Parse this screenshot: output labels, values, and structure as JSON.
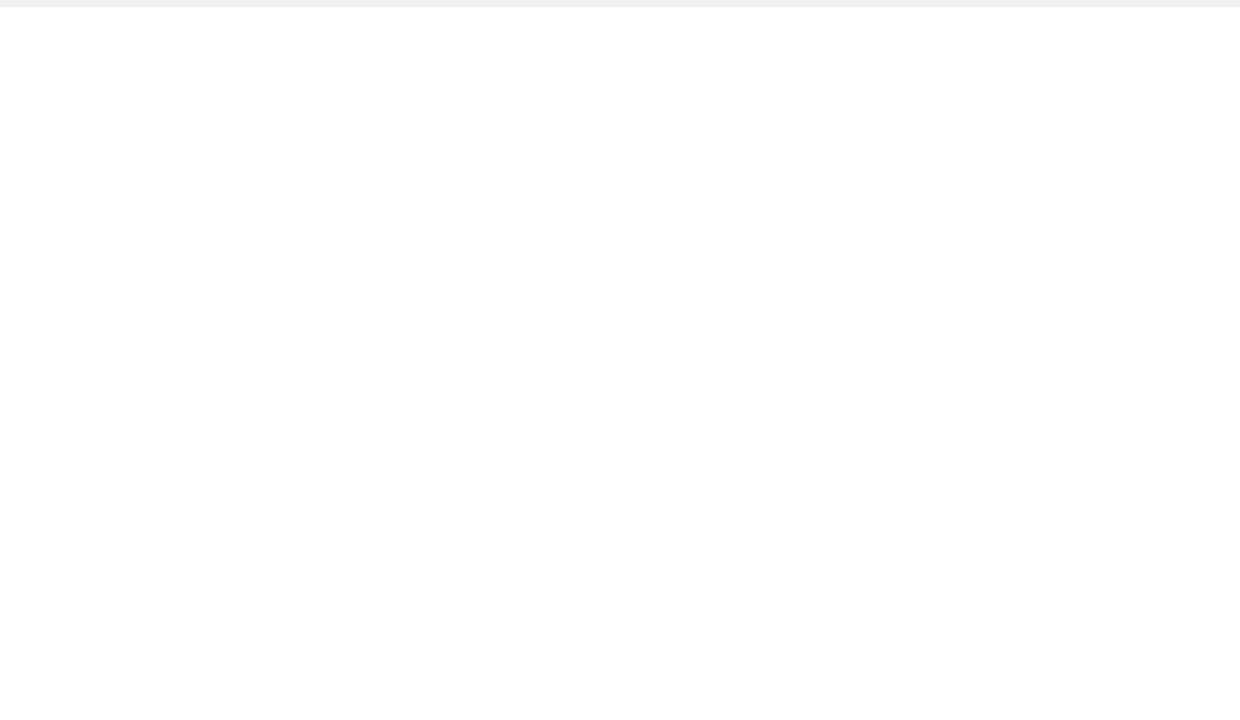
{
  "plan": {
    "band_units": [
      "V05",
      "V06",
      "V07",
      "V08",
      "V09",
      "V10",
      "V11",
      "V12",
      "V13",
      "V14",
      "V15",
      "V16",
      "V17",
      "V18"
    ],
    "block_units": [
      "V01",
      "V02",
      "V03",
      "V04"
    ],
    "annotations": {
      "zonas_comunes_line1": "Zonas Comunes",
      "zonas_comunes_line2": "470,26 m2",
      "lamina_line1": "Lámina de agua",
      "lamina_line2": "62,50 m2",
      "inst1_line1": "Inst. 1",
      "inst1_line2": "Placas",
      "inst2_line1": "Inst. 2",
      "inst2_line2": "Piscina"
    }
  },
  "table": {
    "title": "Resumen de Superficies VIVIENDAS PLANTA BAJA",
    "columns": [
      "",
      "Dormitorios (nº)",
      "Baños (nº)",
      "Parcela (m²)",
      "Ocupación PB (m²)",
      "Construida Total (m²)",
      "Jardines PB (m²)",
      "Terraza (m²)",
      "Solarium (m²)",
      "Trastero (m²)"
    ],
    "rows": [
      [
        "V-01",
        "2",
        "2",
        "355,51",
        "71,71",
        "79,58",
        "174,99",
        "-",
        "-",
        "-"
      ],
      [
        "V-02",
        "2",
        "2",
        "336,08",
        "71,11",
        "77,63",
        "89,13",
        "-",
        "-",
        "-"
      ],
      [
        "V-03",
        "2",
        "2",
        "336,76",
        "71,11",
        "77,63",
        "92,63",
        "-",
        "-",
        "-"
      ],
      [
        "V-04",
        "2",
        "2",
        "336,88",
        "71,71",
        "79,58",
        "119,37",
        "-",
        "-",
        "-"
      ],
      [
        "V-05",
        "2",
        "2",
        "337,83",
        "72,04",
        "80,61",
        "88,19",
        "-",
        "-",
        "-"
      ],
      [
        "V-06",
        "2",
        "2",
        "334,58",
        "71,04",
        "78,65",
        "94,94",
        "-",
        "-",
        "-"
      ],
      [
        "V-07",
        "2",
        "2",
        "336,69",
        "71,04",
        "78,65",
        "93,99",
        "-",
        "-",
        "-"
      ],
      [
        "V-08",
        "2",
        "2",
        "325,40",
        "71,04",
        "78,65",
        "97,45",
        "-",
        "-",
        "-"
      ],
      [
        "V-09",
        "2",
        "2",
        "335,69",
        "71,04",
        "78,65",
        "98,05",
        "-",
        "-",
        "-"
      ],
      [
        "V-10",
        "2",
        "2",
        "355,75",
        "71,18",
        "80,05",
        "98,93",
        "-",
        "-",
        "-"
      ],
      [
        "V-11",
        "2",
        "2",
        "336,70",
        "71,13",
        "80,05",
        "96,99",
        "-",
        "-",
        "-"
      ],
      [
        "V-12",
        "2",
        "2",
        "336,78",
        "71,04",
        "78,65",
        "96,76",
        "-",
        "-",
        "-"
      ],
      [
        "V-13",
        "2",
        "2",
        "335,72",
        "71,04",
        "78,65",
        "98,47",
        "-",
        "-",
        "-"
      ],
      [
        "V-14",
        "2",
        "2",
        "335,50",
        "71,04",
        "78,65",
        "93,88",
        "-",
        "-",
        "-"
      ],
      [
        "V-15",
        "2",
        "2",
        "335,45",
        "71,04",
        "78,65",
        "96,47",
        "-",
        "-",
        "-"
      ],
      [
        "V-16",
        "2",
        "2",
        "335,50",
        "71,04",
        "78,65",
        "93,88",
        "-",
        "-",
        "-"
      ],
      [
        "V-17",
        "2",
        "2",
        "335,84",
        "71,16",
        "79,48",
        "95,88",
        "-",
        "-",
        "-"
      ],
      [
        "V-18",
        "3",
        "2",
        "398,35",
        "56,20",
        [
          "56,22",
          "58,55"
        ],
        "149,85",
        [
          "3,4",
          "6"
        ],
        "55,6",
        "0"
      ]
    ],
    "total_label": "TOTAL PB",
    "total_value": "1457,23"
  },
  "footer": {
    "bar_color": "#5c2d0e",
    "accent_color": "#a34b10"
  }
}
